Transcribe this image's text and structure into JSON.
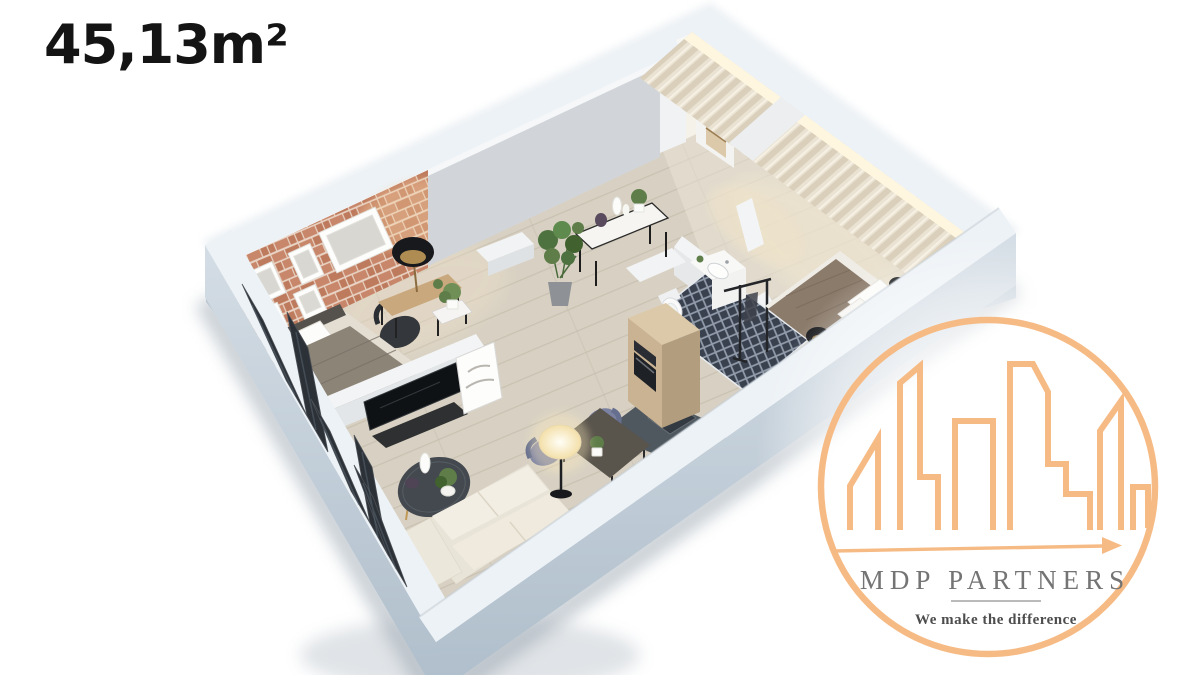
{
  "area_label": "45,13m²",
  "logo": {
    "name": "MDP PARTNERS",
    "tagline": "We make the difference"
  },
  "palette": {
    "label": "#141414",
    "orange": "#F6BB85",
    "logo_gray": "#747474",
    "tagline_gray": "#4D4D4D",
    "wall_top": "#EDF2F6",
    "wall_outer": "#C2CFDA",
    "wall_gray": "#D1D5D9",
    "white_wall": "#F3F4F5",
    "brick": "#C8876A",
    "brick_alt": "#BE7A5D",
    "mortar": "#E9D4C5",
    "floor": "#D8D1C3",
    "floor_light": "#EAE4D8",
    "plank_line": "#C6BEAE",
    "curtain": "#EAE2D2",
    "curtain_stripe": "#DACFBA",
    "curtain_glow": "#FFF6DF",
    "tile": "#39414F",
    "grout": "#939DAB",
    "wood_cabinet": "#C9B392",
    "wood_cabinet_top": "#DCC9A9",
    "counter": "#4F575F",
    "dining_table": "#59544C",
    "desk_wood": "#CAA87E",
    "sofa": "#E9E4D8",
    "cushion": "#F2EEE3",
    "blanket_gray": "#8D8478",
    "blanket_brown": "#8B7B6B",
    "door_dark": "#2C3137",
    "coffee_table": "#43494F",
    "chair_blue": "#7B81A1",
    "plant_green": "#5E7D49",
    "black": "#17191C"
  },
  "scene": {
    "type": "isometric-3d-floor-plan",
    "rooms": [
      "living-room",
      "dining-area",
      "kitchen",
      "bathroom",
      "bedroom",
      "entry-hall"
    ],
    "furnishings": [
      "brick-accent-wall",
      "framed-pictures",
      "single-bed",
      "desk-with-lamp",
      "desk-chair",
      "tv-unit",
      "leaning-art",
      "coffee-table",
      "sofa",
      "dining-table",
      "blue-chairs",
      "glowing-floor-lamp",
      "kitchen-column-with-oven",
      "counter-with-sink",
      "mosaic-tile-floor",
      "vanity-with-basin",
      "toilet",
      "clothes-rack",
      "double-bed",
      "bedside-lamps",
      "console-table-with-vases",
      "monstera-plant",
      "entry-wardrobe",
      "curtained-windows",
      "black-folding-glass-doors"
    ]
  }
}
